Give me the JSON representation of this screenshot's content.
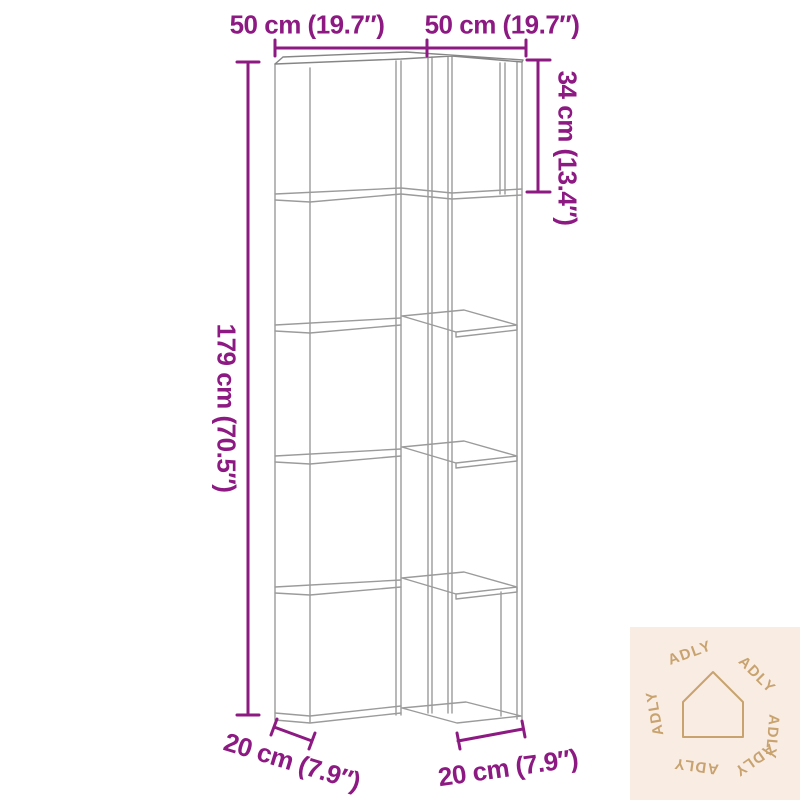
{
  "diagram": {
    "subject": "corner bookshelf line drawing, 5 tiers",
    "dimensions": {
      "top_left": "50 cm (19.7″)",
      "top_right": "50 cm (19.7″)",
      "height_left": "179 cm (70.5″)",
      "top_section_right": "34 cm (13.4″)",
      "depth_bottom_left": "20 cm (7.9″)",
      "depth_bottom_right": "20 cm (7.9″)"
    }
  },
  "watermark": {
    "brand": "ADLY",
    "ring": [
      "ADLY",
      "ADLY",
      "ADLY",
      "ADLY",
      "ADLY",
      "ADLY"
    ]
  },
  "colors": {
    "dimension": "#8c1a82",
    "wireframe": "#9b9b9b",
    "wireframe_dark": "#6f6f6f",
    "watermark_bg": "#f9ece3",
    "watermark_fg": "#c8a36f"
  }
}
